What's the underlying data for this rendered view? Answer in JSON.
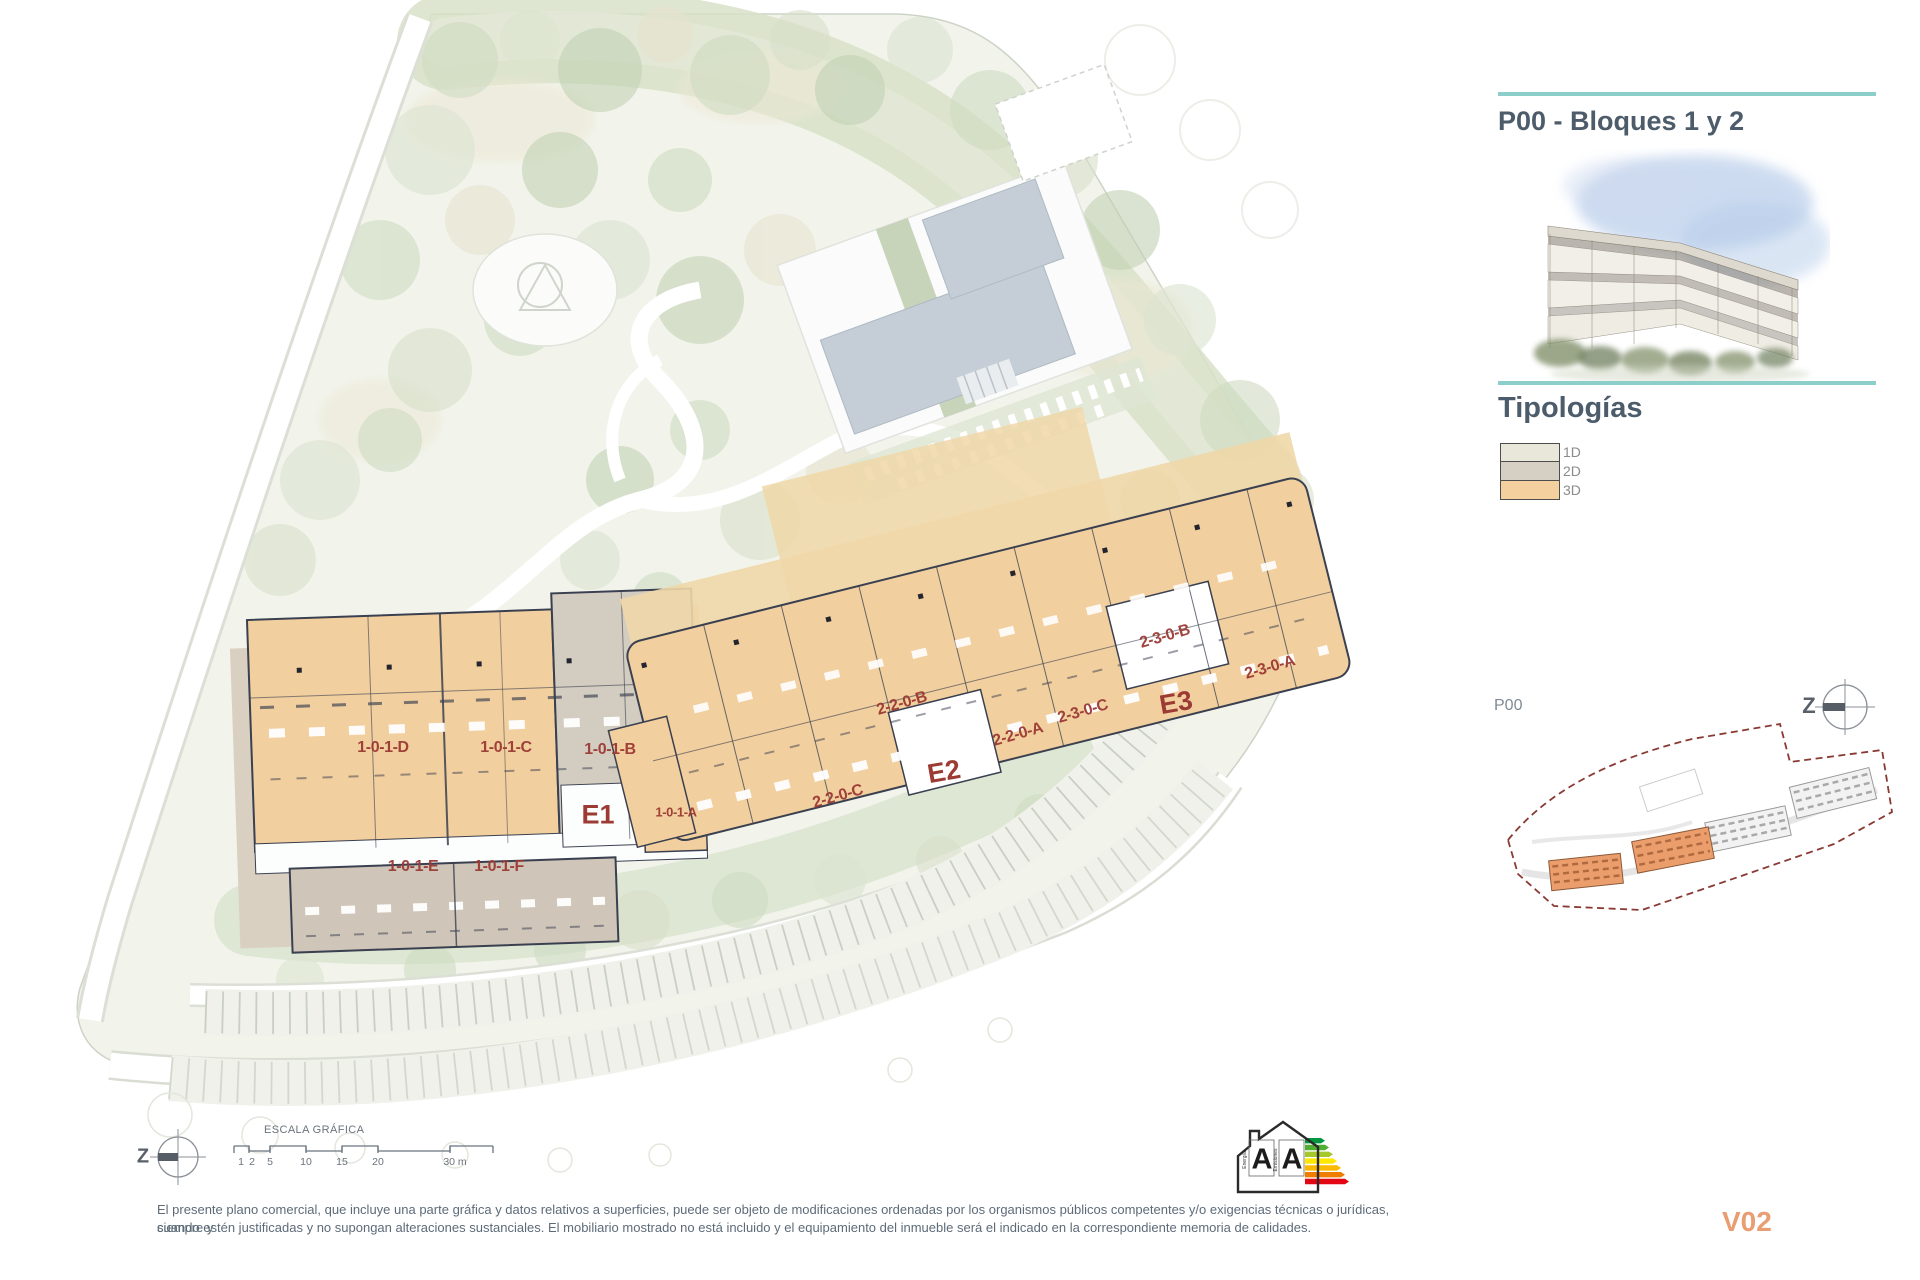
{
  "sheet": {
    "title": "P00 - Bloques 1 y 2",
    "version": "V02",
    "disclaimer_line1": "El presente plano comercial, que incluye una parte gráfica y datos relativos a superficies, puede ser objeto de modificaciones ordenadas por los organismos públicos competentes y/o exigencias técnicas o jurídicas, siempre y",
    "disclaimer_line2": "cuando estén justificadas y no supongan alteraciones sustanciales. El mobiliario mostrado no está incluido y el equipamiento del inmueble será el indicado en la correspondiente memoria de calidades."
  },
  "legend": {
    "heading": "Tipologías",
    "items": [
      {
        "label": "1D",
        "color": "#e9e6da"
      },
      {
        "label": "2D",
        "color": "#d6cfc3"
      },
      {
        "label": "3D",
        "color": "#f4d09f"
      }
    ]
  },
  "minimap": {
    "label": "P00"
  },
  "north": {
    "label": "Z"
  },
  "scale_bar": {
    "title": "ESCALA GRÁFICA",
    "ticks": [
      "1",
      "2",
      "5",
      "10",
      "15",
      "20",
      "30 m"
    ]
  },
  "energy_badge": {
    "letter_left": "A",
    "letter_right": "A",
    "axis_left": "Energía",
    "axis_right": "Emisiones"
  },
  "plan": {
    "units": [
      {
        "label": "1-0-1-D"
      },
      {
        "label": "1-0-1-C"
      },
      {
        "label": "1-0-1-B"
      },
      {
        "label": "1-0-1-A"
      },
      {
        "label": "1-0-1-E"
      },
      {
        "label": "1-0-1-F"
      },
      {
        "label": "2-2-0-C"
      },
      {
        "label": "2-2-0-B"
      },
      {
        "label": "2-2-0-A"
      },
      {
        "label": "2-3-0-C"
      },
      {
        "label": "2-3-0-B"
      },
      {
        "label": "2-3-0-A"
      }
    ],
    "cores": [
      {
        "label": "E1"
      },
      {
        "label": "E2"
      },
      {
        "label": "E3"
      }
    ]
  },
  "colors": {
    "accent_teal": "#8ccfca",
    "title_text": "#4d5c6b",
    "unit_label_red": "#9c3a34",
    "version_orange": "#e99d72",
    "plan_orange_3d": "#f2cf9e",
    "plan_gray_2d": "#d3ccc0",
    "plan_taupe": "#cfc5b8",
    "floorplan_line": "#3a4050"
  }
}
